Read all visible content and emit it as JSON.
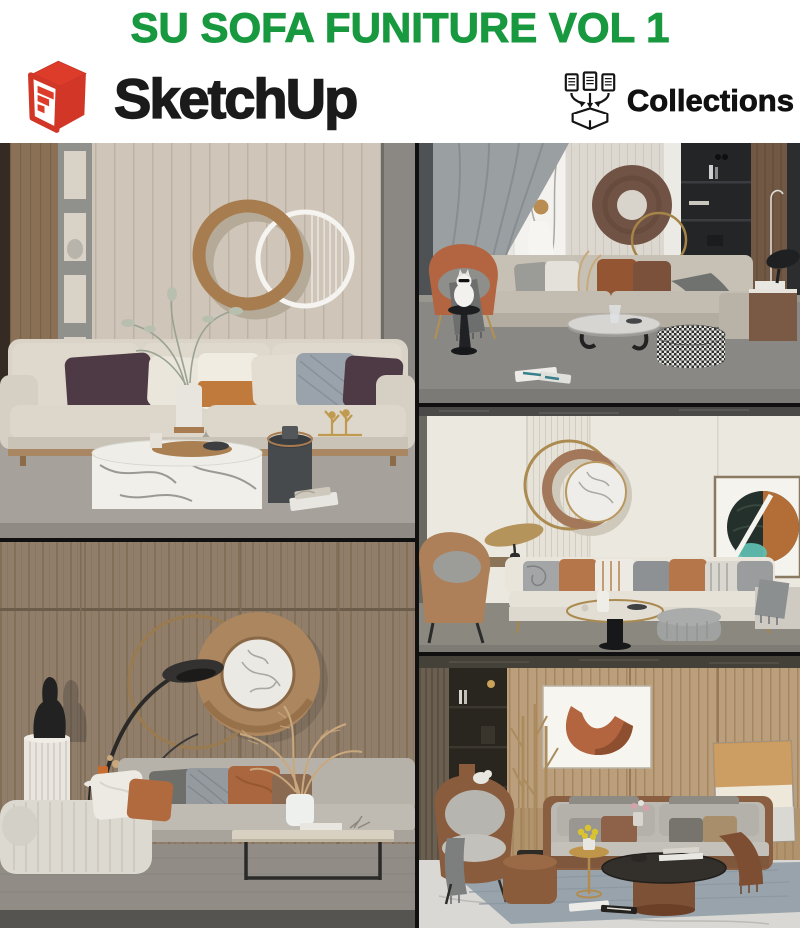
{
  "header": {
    "title": "SU SOFA FUNITURE VOL 1",
    "sketchup_label": "SketchUp",
    "collections_label": "Collections"
  },
  "brand_colors": {
    "title_green": "#18993F",
    "sketchup_red": "#D93A2B",
    "text_black": "#1B1B1B"
  },
  "icons": [
    {
      "name": "sketchup-logo-icon",
      "meaning": "red 3D box with white staircase face"
    },
    {
      "name": "collections-box-icon",
      "meaning": "three documents with arrows dropping into an open box"
    }
  ],
  "panels": [
    {
      "id": "scene-1",
      "alt": "Beige living room with slatted wall, overlapping brown and white ring wall art, light fabric sofa with plum and amber cushions, round marble drum coffee table and dark cylinder side table"
    },
    {
      "id": "scene-2",
      "alt": "Gray-toned lounge with sheer curtain, marble relief panel, brown torus wall sculpture, beige sofa, terracotta armchair, white cat on a stool and houndstooth ottoman"
    },
    {
      "id": "scene-3",
      "alt": "Cream paneled wall with gold ring and marble disc art, white modern sofa with rust and gray pillows, tan lounge chair, brass-edged round coffee table and framed abstract art"
    },
    {
      "id": "scene-4",
      "alt": "Dark wood wall with large bronze disc and marble center, black arc floor lamp, black bust on fluted pedestal, gray sofa with ribbed chaise and slim travertine coffee table"
    },
    {
      "id": "scene-5",
      "alt": "Warm wood slat wall with abstract terracotta artwork, gray sofa with leather trim, curved armchair, round leather-base coffee table, brass side table and dark bookshelf"
    }
  ]
}
